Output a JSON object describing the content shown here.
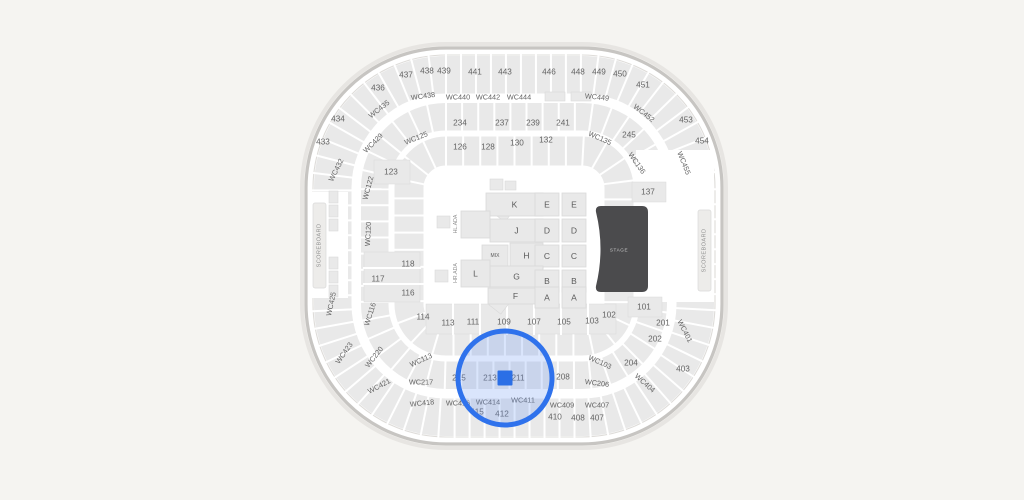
{
  "theme": {
    "background": "#f5f4f1",
    "arena_fill": "#ffffff",
    "wall": "#c7c5c2",
    "wall_inner": "#dedcd9",
    "section_fill": "#e9e9e9",
    "section_stroke": "#d9d9d9",
    "label_color": "#636363",
    "stage_fill": "#4b4b4d",
    "stage_text": "#c9c9c9",
    "scoreboard_fill": "#edecea",
    "scoreboard_text": "#8f8f8f",
    "selection_stroke": "#2f72ec",
    "selection_fill": "#6a97f2",
    "marker_fill": "#2b6fe6"
  },
  "arena": {
    "stage_label": "STAGE",
    "scoreboard_left": "SCOREBOARD",
    "scoreboard_right": "SCOREBOARD",
    "ada_top": "HL.ADA",
    "ada_bottom": "HR.ADA"
  },
  "selection": {
    "cx": 505,
    "cy": 378,
    "r": 47,
    "marker": {
      "x": 497.5,
      "y": 370.5,
      "w": 15,
      "h": 15
    },
    "selected_sections": [
      "213",
      "211"
    ]
  },
  "floor_blocks": [
    {
      "label": "K",
      "x": 486,
      "y": 193,
      "w": 57,
      "h": 23
    },
    {
      "label": "E",
      "x": 535,
      "y": 193,
      "w": 24,
      "h": 23
    },
    {
      "label": "E",
      "x": 562,
      "y": 193,
      "w": 24,
      "h": 23
    },
    {
      "label": "J",
      "x": 490,
      "y": 219,
      "w": 53,
      "h": 23
    },
    {
      "label": "D",
      "x": 535,
      "y": 219,
      "w": 24,
      "h": 23
    },
    {
      "label": "D",
      "x": 562,
      "y": 219,
      "w": 24,
      "h": 23
    },
    {
      "label": "MIX",
      "x": 482,
      "y": 245,
      "w": 26,
      "h": 22
    },
    {
      "label": "H",
      "x": 510,
      "y": 243,
      "w": 33,
      "h": 25
    },
    {
      "label": "C",
      "x": 535,
      "y": 245,
      "w": 24,
      "h": 22
    },
    {
      "label": "C",
      "x": 562,
      "y": 245,
      "w": 24,
      "h": 22
    },
    {
      "label": "G",
      "x": 490,
      "y": 266,
      "w": 53,
      "h": 21
    },
    {
      "label": "B",
      "x": 535,
      "y": 270,
      "w": 24,
      "h": 22
    },
    {
      "label": "B",
      "x": 562,
      "y": 270,
      "w": 24,
      "h": 22
    },
    {
      "label": "F",
      "x": 488,
      "y": 288,
      "w": 55,
      "h": 16
    },
    {
      "label": "A",
      "x": 535,
      "y": 287,
      "w": 24,
      "h": 21
    },
    {
      "label": "A",
      "x": 562,
      "y": 287,
      "w": 24,
      "h": 21
    },
    {
      "label": "",
      "x": 461,
      "y": 211,
      "w": 29,
      "h": 27
    },
    {
      "label": "L",
      "x": 461,
      "y": 260,
      "w": 29,
      "h": 27
    }
  ],
  "section_labels": [
    {
      "t": "433",
      "x": 323,
      "y": 142,
      "r": 0
    },
    {
      "t": "434",
      "x": 338,
      "y": 119,
      "r": 0
    },
    {
      "t": "436",
      "x": 378,
      "y": 88,
      "r": 0
    },
    {
      "t": "437",
      "x": 406,
      "y": 75,
      "r": 0
    },
    {
      "t": "438",
      "x": 427,
      "y": 71,
      "r": 0
    },
    {
      "t": "439",
      "x": 444,
      "y": 71,
      "r": 0
    },
    {
      "t": "441",
      "x": 475,
      "y": 72,
      "r": 0
    },
    {
      "t": "443",
      "x": 505,
      "y": 72,
      "r": 0
    },
    {
      "t": "446",
      "x": 549,
      "y": 72,
      "r": 0
    },
    {
      "t": "448",
      "x": 578,
      "y": 72,
      "r": 0
    },
    {
      "t": "449",
      "x": 599,
      "y": 72,
      "r": 0
    },
    {
      "t": "450",
      "x": 620,
      "y": 74,
      "r": 0
    },
    {
      "t": "451",
      "x": 643,
      "y": 85,
      "r": 0
    },
    {
      "t": "453",
      "x": 686,
      "y": 120,
      "r": 0
    },
    {
      "t": "454",
      "x": 702,
      "y": 141,
      "r": 0
    },
    {
      "t": "WC435",
      "x": 379,
      "y": 109,
      "r": -38
    },
    {
      "t": "WC438",
      "x": 423,
      "y": 96,
      "r": -8
    },
    {
      "t": "WC440",
      "x": 458,
      "y": 97,
      "r": 0
    },
    {
      "t": "WC442",
      "x": 488,
      "y": 97,
      "r": 0
    },
    {
      "t": "WC444",
      "x": 519,
      "y": 97,
      "r": 0
    },
    {
      "t": "WC449",
      "x": 597,
      "y": 97,
      "r": 6
    },
    {
      "t": "WC452",
      "x": 644,
      "y": 113,
      "r": 38
    },
    {
      "t": "WC455",
      "x": 684,
      "y": 163,
      "r": 68
    },
    {
      "t": "WC432",
      "x": 336,
      "y": 170,
      "r": -63
    },
    {
      "t": "WC429",
      "x": 373,
      "y": 143,
      "r": -45
    },
    {
      "t": "WC125",
      "x": 416,
      "y": 138,
      "r": -22
    },
    {
      "t": "WC135",
      "x": 600,
      "y": 138,
      "r": 24
    },
    {
      "t": "WC136",
      "x": 637,
      "y": 163,
      "r": 55
    },
    {
      "t": "WC122",
      "x": 368,
      "y": 188,
      "r": -75
    },
    {
      "t": "WC120",
      "x": 368,
      "y": 234,
      "r": -87
    },
    {
      "t": "WC116",
      "x": 370,
      "y": 314,
      "r": -72
    },
    {
      "t": "WC113",
      "x": 421,
      "y": 360,
      "r": -25
    },
    {
      "t": "WC217",
      "x": 421,
      "y": 382,
      "r": 0
    },
    {
      "t": "WC220",
      "x": 374,
      "y": 357,
      "r": -52
    },
    {
      "t": "WC425",
      "x": 331,
      "y": 304,
      "r": -78
    },
    {
      "t": "WC423",
      "x": 344,
      "y": 353,
      "r": -55
    },
    {
      "t": "WC421",
      "x": 379,
      "y": 386,
      "r": -28
    },
    {
      "t": "WC418",
      "x": 422,
      "y": 403,
      "r": -6
    },
    {
      "t": "WC416",
      "x": 458,
      "y": 403,
      "r": 0
    },
    {
      "t": "WC414",
      "x": 488,
      "y": 402,
      "r": 0
    },
    {
      "t": "WC411",
      "x": 523,
      "y": 400,
      "r": 0
    },
    {
      "t": "WC409",
      "x": 562,
      "y": 405,
      "r": 0
    },
    {
      "t": "WC407",
      "x": 597,
      "y": 405,
      "r": 0
    },
    {
      "t": "WC404",
      "x": 645,
      "y": 383,
      "r": 42
    },
    {
      "t": "WC401",
      "x": 685,
      "y": 331,
      "r": 63
    },
    {
      "t": "WC103",
      "x": 600,
      "y": 362,
      "r": 24
    },
    {
      "t": "WC206",
      "x": 597,
      "y": 383,
      "r": 7
    },
    {
      "t": "234",
      "x": 460,
      "y": 123,
      "r": 0
    },
    {
      "t": "237",
      "x": 502,
      "y": 123,
      "r": 0
    },
    {
      "t": "239",
      "x": 533,
      "y": 123,
      "r": 0
    },
    {
      "t": "241",
      "x": 563,
      "y": 123,
      "r": 0
    },
    {
      "t": "245",
      "x": 629,
      "y": 135,
      "r": 0
    },
    {
      "t": "126",
      "x": 460,
      "y": 147,
      "r": 0
    },
    {
      "t": "128",
      "x": 488,
      "y": 147,
      "r": 0
    },
    {
      "t": "130",
      "x": 517,
      "y": 143,
      "r": 0
    },
    {
      "t": "132",
      "x": 546,
      "y": 140,
      "r": 0
    },
    {
      "t": "123",
      "x": 391,
      "y": 172,
      "r": 0
    },
    {
      "t": "137",
      "x": 648,
      "y": 192,
      "r": 0
    },
    {
      "t": "118",
      "x": 408,
      "y": 264,
      "r": 0
    },
    {
      "t": "117",
      "x": 378,
      "y": 279,
      "r": 0
    },
    {
      "t": "116",
      "x": 408,
      "y": 293,
      "r": 0
    },
    {
      "t": "114",
      "x": 423,
      "y": 317,
      "r": 0
    },
    {
      "t": "113",
      "x": 448,
      "y": 323,
      "r": 0
    },
    {
      "t": "111",
      "x": 473,
      "y": 322,
      "r": 0
    },
    {
      "t": "109",
      "x": 504,
      "y": 322,
      "r": 0
    },
    {
      "t": "107",
      "x": 534,
      "y": 322,
      "r": 0
    },
    {
      "t": "105",
      "x": 564,
      "y": 322,
      "r": 0
    },
    {
      "t": "103",
      "x": 592,
      "y": 321,
      "r": 0
    },
    {
      "t": "102",
      "x": 609,
      "y": 315,
      "r": 0
    },
    {
      "t": "101",
      "x": 644,
      "y": 307,
      "r": 0
    },
    {
      "t": "201",
      "x": 663,
      "y": 323,
      "r": 0
    },
    {
      "t": "202",
      "x": 655,
      "y": 339,
      "r": 0
    },
    {
      "t": "204",
      "x": 631,
      "y": 363,
      "r": 0
    },
    {
      "t": "208",
      "x": 563,
      "y": 377,
      "r": 0
    },
    {
      "t": "211",
      "x": 518,
      "y": 378,
      "r": 0
    },
    {
      "t": "213",
      "x": 490,
      "y": 378,
      "r": 0
    },
    {
      "t": "215",
      "x": 459,
      "y": 378,
      "r": 0
    },
    {
      "t": "403",
      "x": 683,
      "y": 369,
      "r": 0
    },
    {
      "t": "415",
      "x": 477,
      "y": 412,
      "r": 0
    },
    {
      "t": "412",
      "x": 502,
      "y": 414,
      "r": 0
    },
    {
      "t": "410",
      "x": 555,
      "y": 417,
      "r": 0
    },
    {
      "t": "408",
      "x": 578,
      "y": 418,
      "r": 0
    },
    {
      "t": "407",
      "x": 597,
      "y": 418,
      "r": 0
    }
  ],
  "decor_rects": [
    {
      "x": 329,
      "y": 191,
      "w": 9,
      "h": 12
    },
    {
      "x": 329,
      "y": 205,
      "w": 9,
      "h": 12
    },
    {
      "x": 329,
      "y": 219,
      "w": 9,
      "h": 12
    },
    {
      "x": 329,
      "y": 257,
      "w": 9,
      "h": 12
    },
    {
      "x": 329,
      "y": 271,
      "w": 9,
      "h": 12
    },
    {
      "x": 329,
      "y": 285,
      "w": 9,
      "h": 12
    },
    {
      "x": 545,
      "y": 92,
      "w": 20,
      "h": 9
    },
    {
      "x": 571,
      "y": 92,
      "w": 20,
      "h": 9
    },
    {
      "x": 437,
      "y": 216,
      "w": 13,
      "h": 12
    },
    {
      "x": 435,
      "y": 270,
      "w": 13,
      "h": 12
    },
    {
      "x": 490,
      "y": 179,
      "w": 13,
      "h": 11
    },
    {
      "x": 505,
      "y": 181,
      "w": 11,
      "h": 9
    }
  ],
  "decor_diamonds": [
    {
      "x": 496,
      "y": 204,
      "s": 15,
      "r": 38
    },
    {
      "x": 492,
      "y": 296,
      "s": 15,
      "r": 38
    }
  ]
}
